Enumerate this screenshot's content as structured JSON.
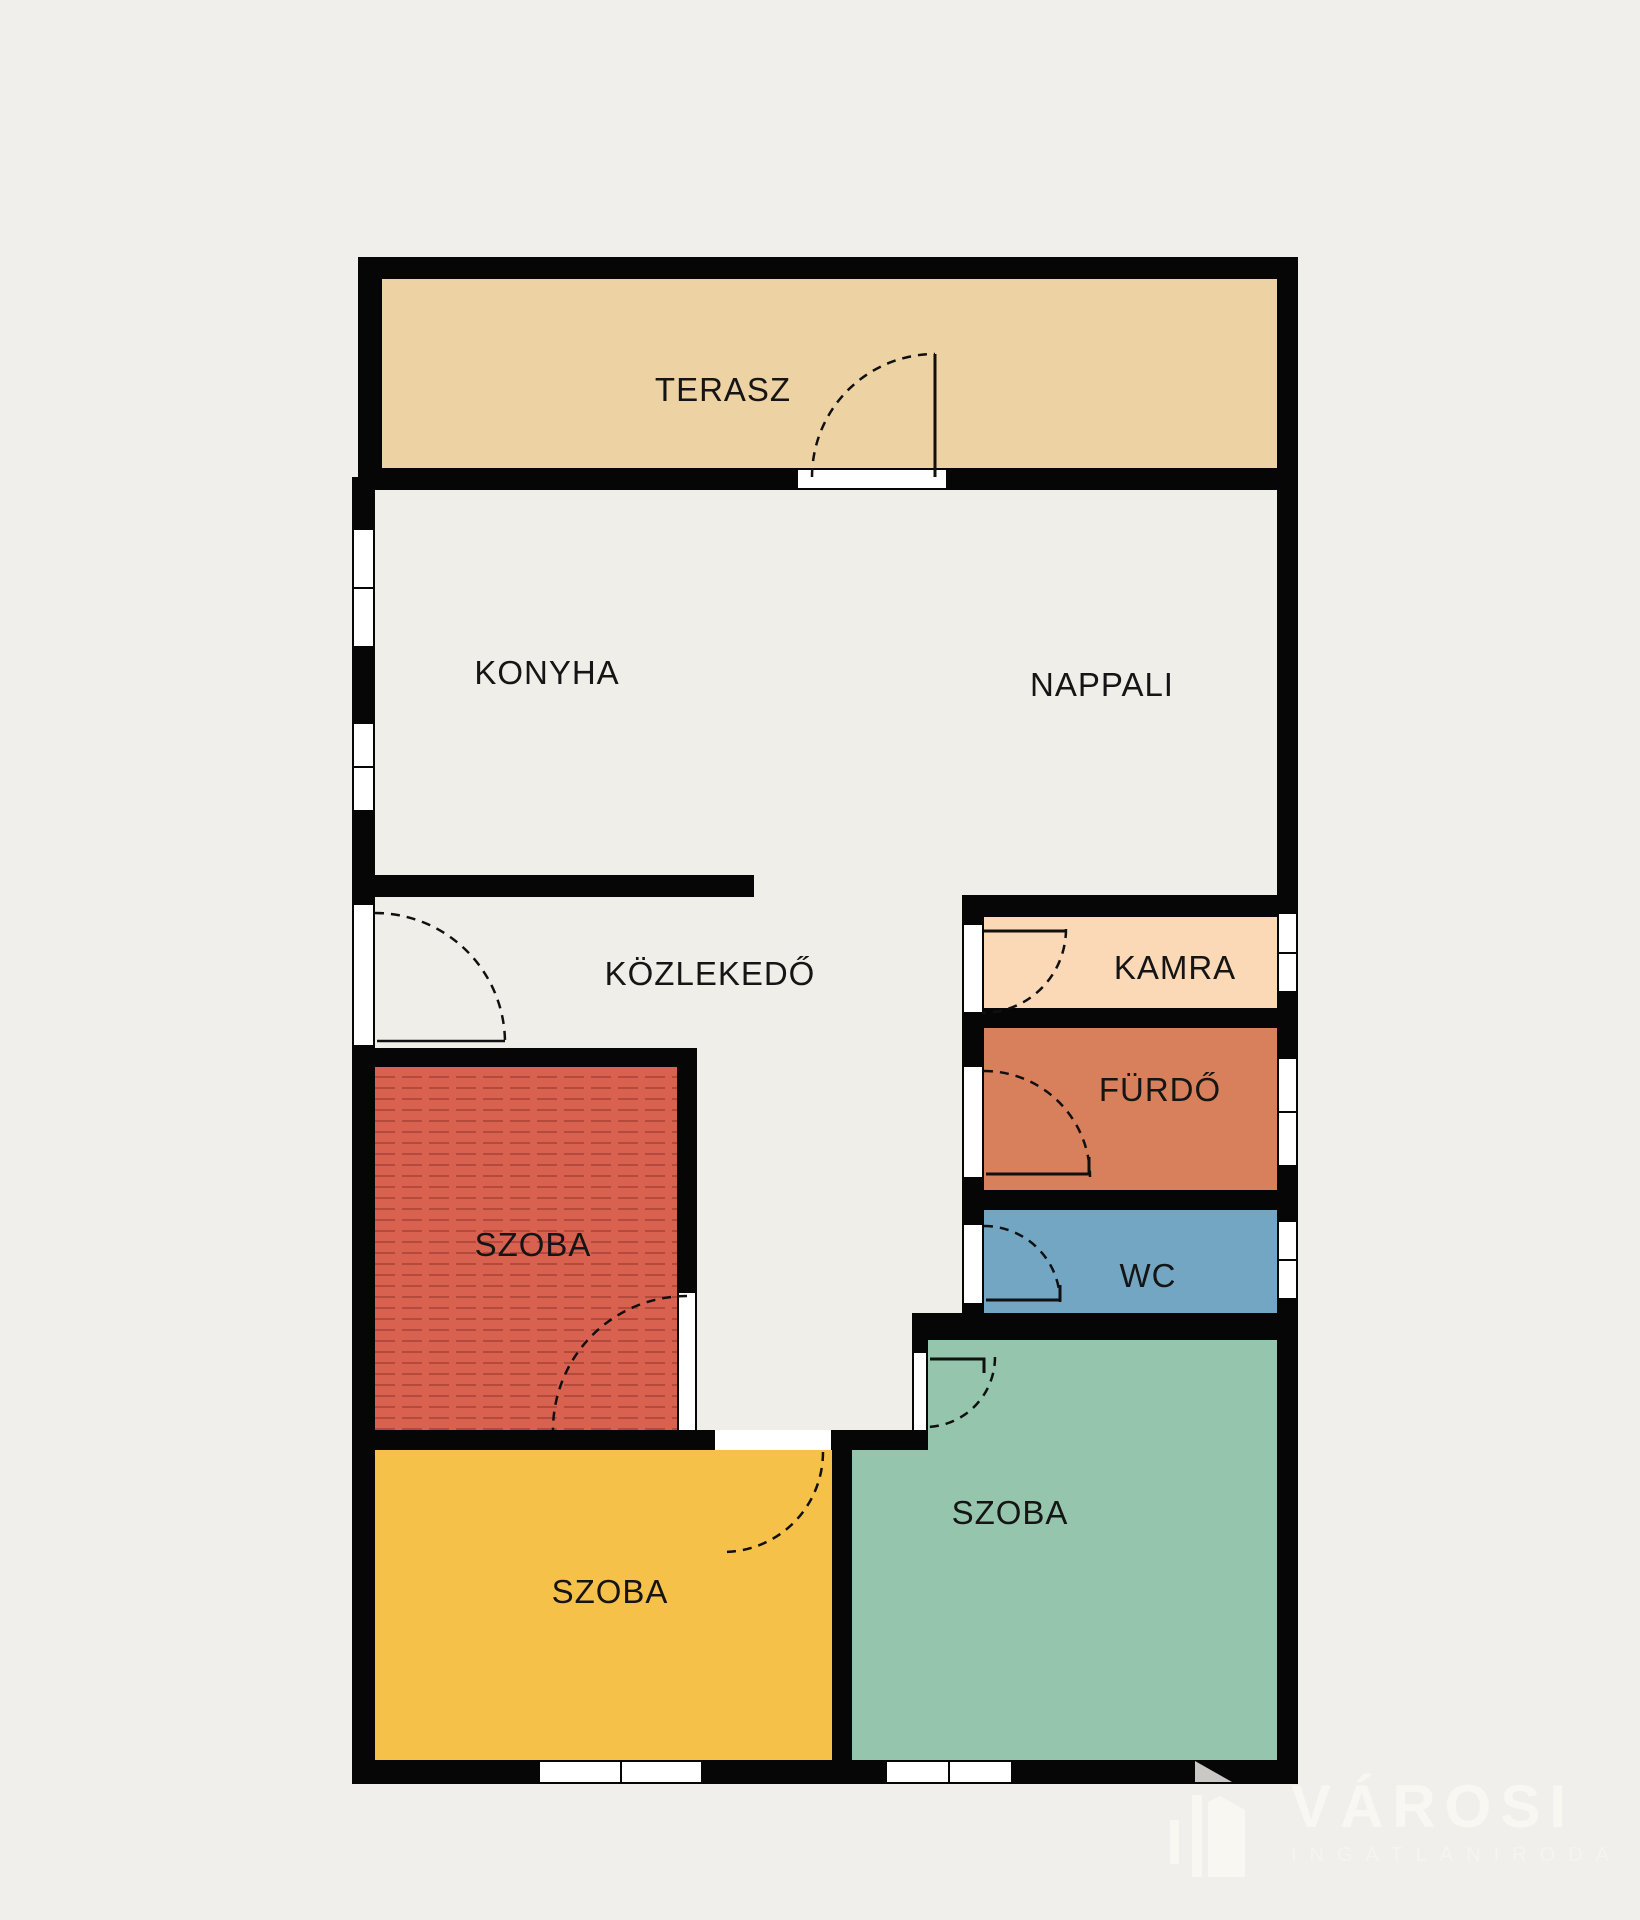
{
  "floorplan": {
    "background_color": "#f0efeb",
    "wall_color": "#060606",
    "floor_color": "#efeee9",
    "rooms": [
      {
        "id": "terasz",
        "label": "TERASZ",
        "color": "#edd2a3"
      },
      {
        "id": "konyha",
        "label": "KONYHA",
        "color": "#efeee9"
      },
      {
        "id": "nappali",
        "label": "NAPPALI",
        "color": "#efeee9"
      },
      {
        "id": "kozlekedo",
        "label": "KÖZLEKEDŐ",
        "color": "#efeee9"
      },
      {
        "id": "kamra",
        "label": "KAMRA",
        "color": "#fbd9b6"
      },
      {
        "id": "furdo",
        "label": "FÜRDŐ",
        "color": "#d8805c"
      },
      {
        "id": "wc",
        "label": "WC",
        "color": "#73a6c3"
      },
      {
        "id": "szoba-1",
        "label": "SZOBA",
        "color": "#d96150"
      },
      {
        "id": "szoba-2",
        "label": "SZOBA",
        "color": "#f6c149"
      },
      {
        "id": "szoba-3",
        "label": "SZOBA",
        "color": "#95c5ad"
      }
    ],
    "watermark": {
      "brand": "VÁROSI",
      "subtitle": "INGATLANIRODA",
      "text_color": "#f8f7f2"
    }
  }
}
